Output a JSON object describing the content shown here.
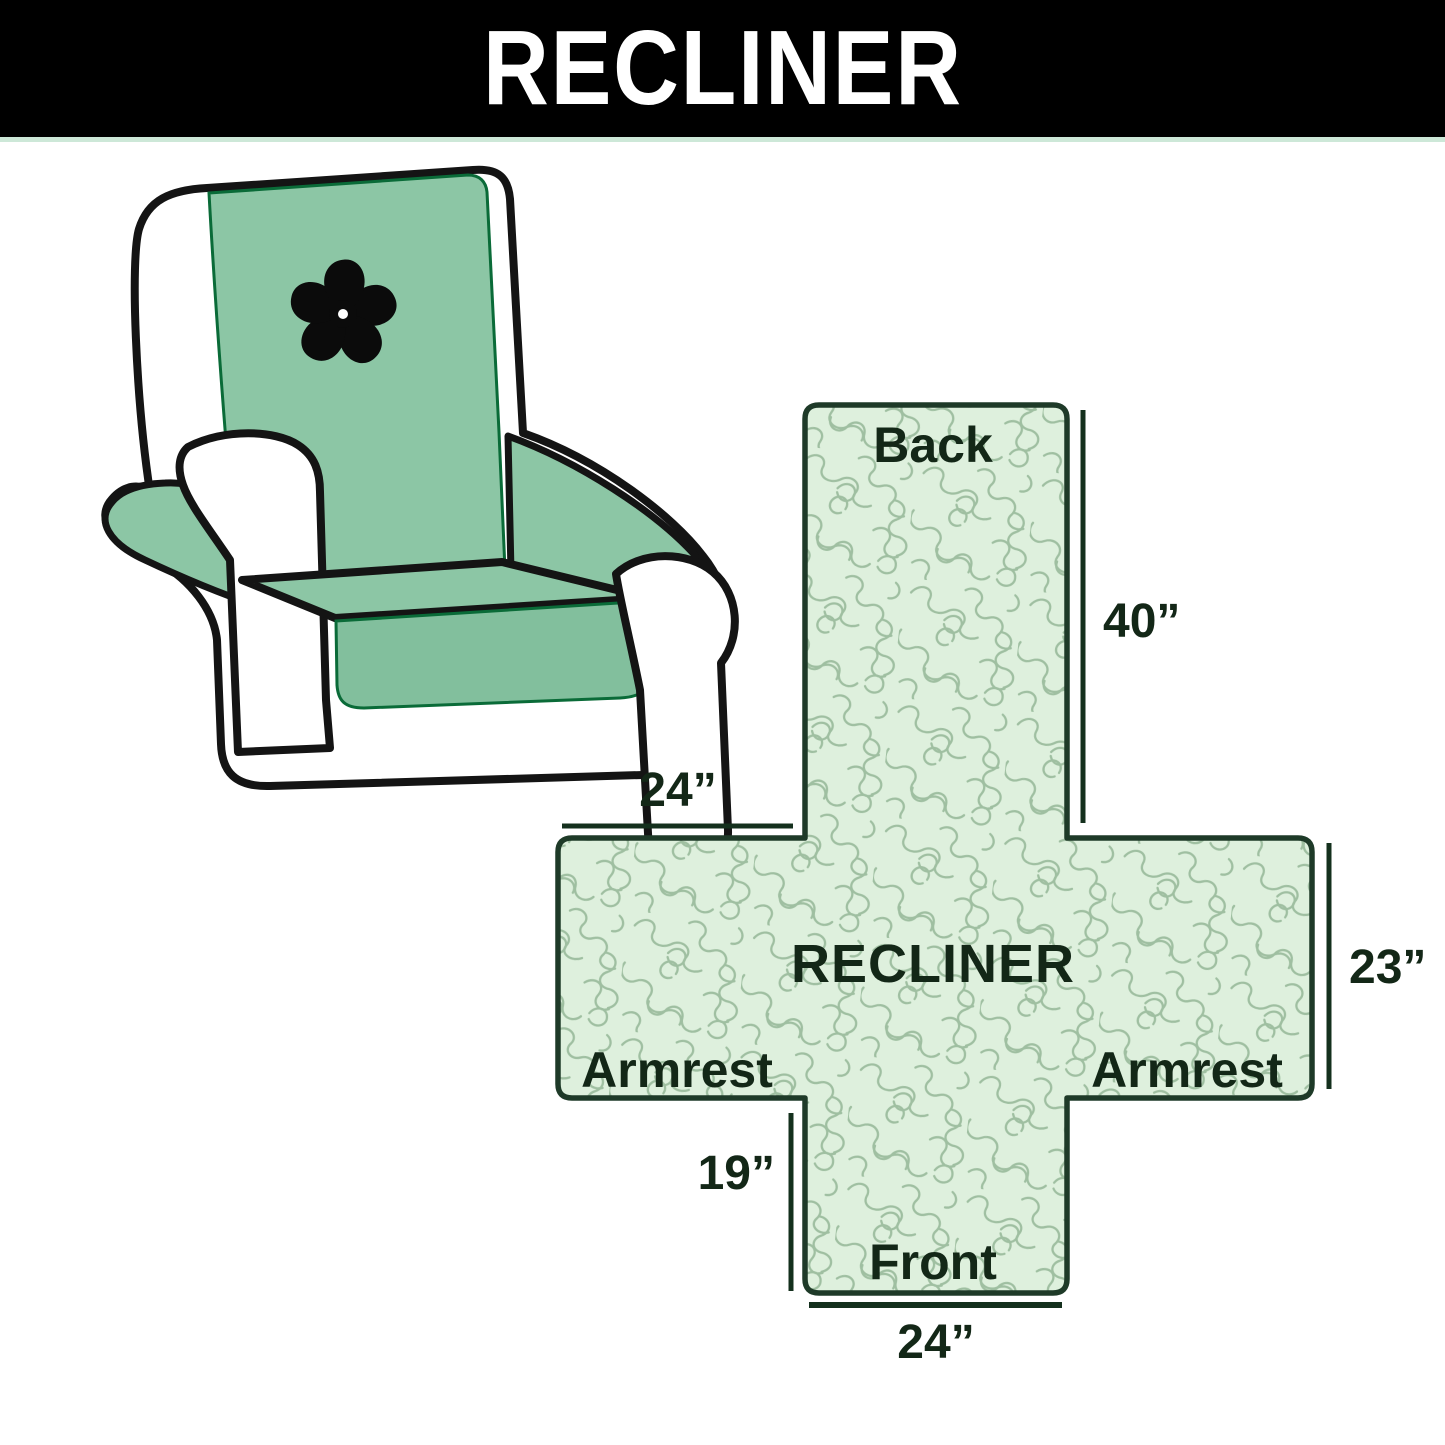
{
  "header": {
    "title": "RECLINER",
    "bg_color": "#000000",
    "text_color": "#ffffff"
  },
  "chair": {
    "logo_icon": "pinwheel-icon",
    "cover_color": "#8cc6a5",
    "outline_color": "#141414"
  },
  "diagram": {
    "center_label": "RECLINER",
    "fabric_fill": "#def0dd",
    "pattern_line_color": "#9fbfa1",
    "outline_color": "#1e3a28",
    "text_color": "#132717",
    "sections": {
      "back": "Back",
      "front": "Front",
      "armrest_left": "Armrest",
      "armrest_right": "Armrest"
    },
    "dimensions": {
      "back_height": "40”",
      "armrest_top_width": "24”",
      "armrest_side_height": "23”",
      "front_flap_height": "19”",
      "front_width": "24”"
    }
  }
}
